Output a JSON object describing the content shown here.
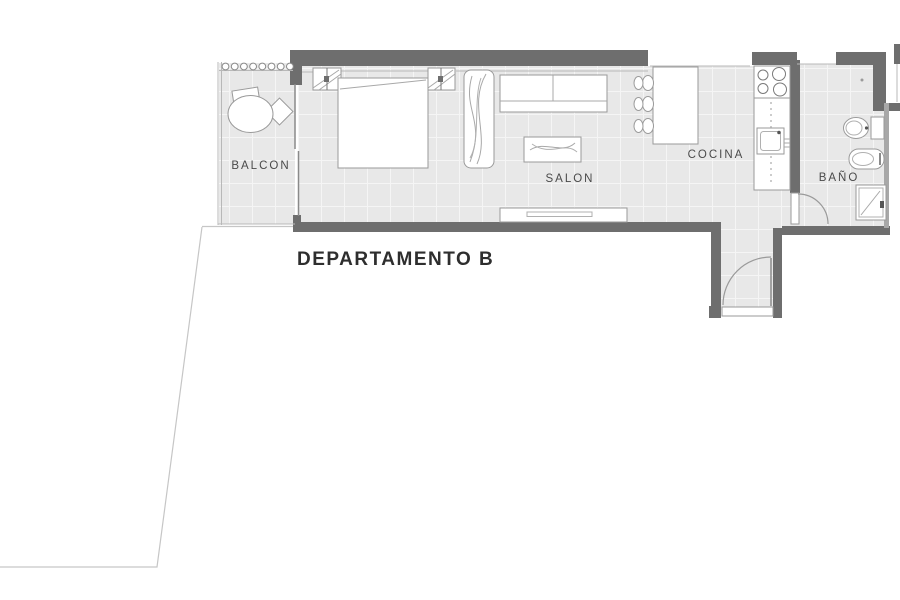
{
  "plan": {
    "title": "DEPARTAMENTO B",
    "rooms": {
      "balcon": {
        "label": "BALCON"
      },
      "salon": {
        "label": "SALON"
      },
      "cocina": {
        "label": "COCINA"
      },
      "bano": {
        "label": "BAÑO"
      }
    },
    "colors": {
      "wall": "#6e6e6e",
      "wall_light": "#a8a8a8",
      "floor": "#e8e8e8",
      "tile_line": "#f5f5f5",
      "furniture_stroke": "#9a9a9a",
      "label_text": "#4a4a4a",
      "title_text": "#2e2e2e",
      "boundary_line": "#c6c6c6"
    }
  }
}
